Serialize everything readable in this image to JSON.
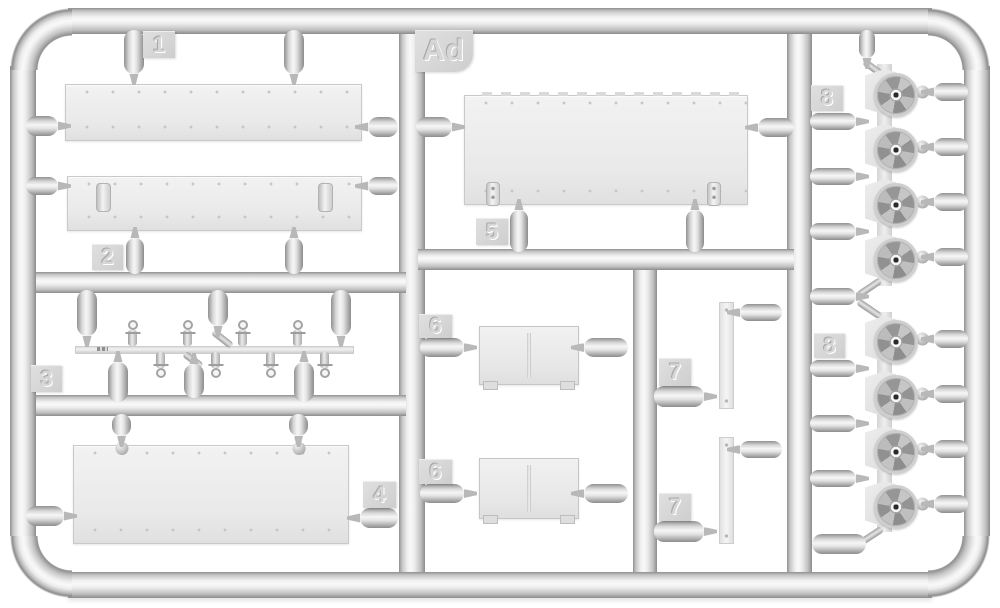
{
  "sprue": {
    "id_tag": "Ad",
    "part_tags": {
      "p1": "1",
      "p2": "2",
      "p3": "3",
      "p4": "4",
      "p5": "5",
      "p6a": "6",
      "p6b": "6",
      "p7a": "7",
      "p7b": "7",
      "p8a": "8",
      "p8b": "8"
    }
  },
  "colors": {
    "background": "#ffffff",
    "plastic_highlight": "#f6f6f6",
    "plastic_mid": "#d9d9d9",
    "plastic_edge": "#8e8e8e",
    "panel_fill": "#ececec",
    "tag_fill": "#d6d6d6",
    "wheel_hub_hole": "#2a2a2a"
  }
}
